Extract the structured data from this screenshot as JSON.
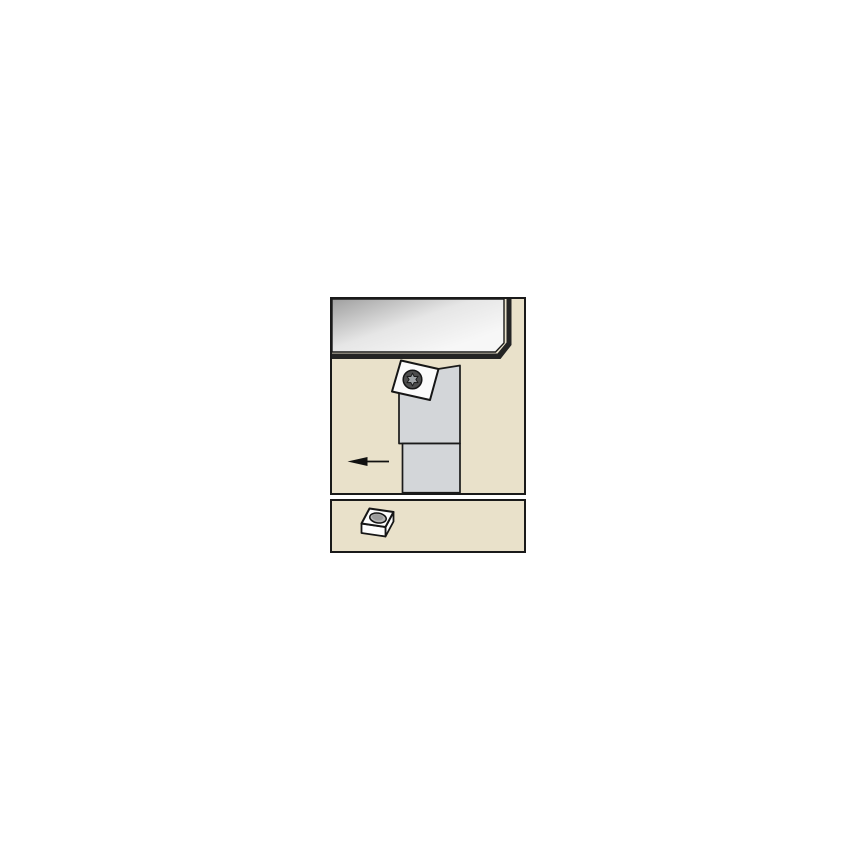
{
  "app": {
    "background_color": "#ffffff",
    "description": "Catalog line illustration: turning tool holder with square indexable insert machining a workpiece, plus insert-shape pictogram panel"
  },
  "colors": {
    "panel_background": "#e9e1ca",
    "panel_border": "#1a1a1a",
    "workpiece_edge_dark": "#242424",
    "toolholder_gray": "#d3d6d9",
    "insert_white": "#fbfbfb",
    "screw_head_gray": "#4d4d4d",
    "screw_torx_gray": "#a0a4a7",
    "arrow_black": "#111111",
    "insert_hole_gray": "#b5b5b5",
    "insert_hole_inner_gray": "#9b9b9b",
    "pictogram_white": "#fdfdfd"
  },
  "panels": {
    "main_view": {
      "name": "toolholder-application-view"
    },
    "insert_view": {
      "name": "insert-shape-pictogram-view"
    }
  },
  "icons": [
    {
      "name": "feed-direction-arrow-icon",
      "meaning": "feed direction, pointing left"
    },
    {
      "name": "torx-screw-icon",
      "meaning": "insert clamp screw head"
    },
    {
      "name": "square-insert-icon",
      "meaning": "square indexable insert with center hole, 3D pictogram"
    }
  ]
}
